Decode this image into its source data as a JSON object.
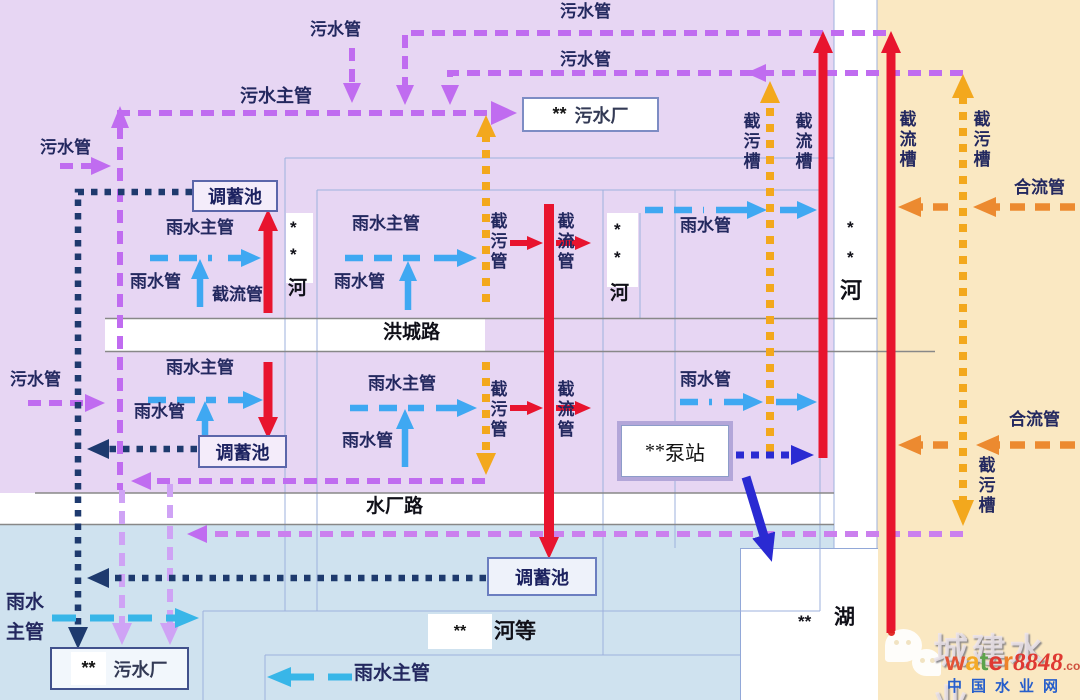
{
  "pipes": {
    "sewage_pipe": "污水管",
    "sewage_main": "污水主管",
    "rain_main": "雨水主管",
    "rain_main_line1": "雨水",
    "rain_main_line2": "主管",
    "rain_pipe": "雨水管",
    "intercept_pipe": "截污管",
    "diversion_pipe": "截流管",
    "intercept_channel": "截污槽",
    "diversion_channel": "截流槽",
    "combined_pipe": "合流管"
  },
  "facilities": {
    "storage_tank": "调蓄池",
    "sewage_plant": "污水厂",
    "pump_station": "泵站",
    "masked_prefix": "**"
  },
  "roads": {
    "hongcheng": "洪城路",
    "shuichang": "水厂路"
  },
  "waters": {
    "river": "河",
    "rivers_etc": "河等",
    "lake": "湖",
    "masked_star": "*"
  },
  "watermark": {
    "brand": "城建水业",
    "letters": {
      "l1": "w",
      "l2": "a",
      "l3": "t",
      "l4": "e",
      "l5": "r"
    },
    "number": "8848",
    "domain": ".com",
    "site": "中国水业网"
  },
  "colors": {
    "sewage_purple": "#c06cf0",
    "rain_blue": "#3fa8f2",
    "storage_navy": "#1e3a6e",
    "diversion_red": "#e8142e",
    "intercept_orange": "#f3a81d",
    "combined_orange": "#ec8a30",
    "pump_royal_blue": "#2a2ad2",
    "bg_left_catchment": "#e7d6f3",
    "bg_right_catchment": "#fae8c2",
    "bg_bottom_catchment": "#cfe2ef"
  }
}
